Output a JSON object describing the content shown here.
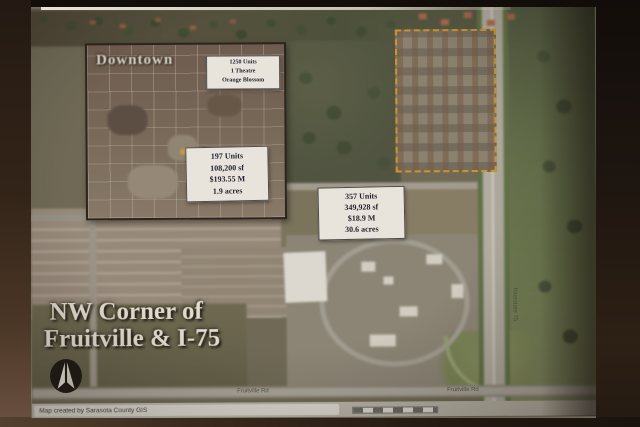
{
  "slide": {
    "inset": {
      "title": "Downtown",
      "program_box": {
        "lines": [
          "1250 Units",
          "1 Theatre",
          "Orange Blossom"
        ]
      },
      "stats_box": {
        "lines": [
          "197 Units",
          "108,200 sf",
          "$193.55 M",
          "1.9 acres"
        ]
      }
    },
    "site_box": {
      "lines": [
        "357 Units",
        "349,928 sf",
        "$18.9 M",
        "30.6 acres"
      ]
    },
    "title": {
      "line1": "NW Corner of",
      "line2": "Fruitville & I-75"
    },
    "roads": {
      "fruitville": "Fruitville Rd",
      "interstate": "Interstate 75"
    },
    "footer": {
      "attribution": "Map created by Sarasota County GIS"
    },
    "icons": {
      "north_arrow": "north-arrow"
    },
    "colors": {
      "parcel_outline": "#d89b2a",
      "wall_brown": "#3b2b1f",
      "field_olive": "#7c7660",
      "highway_gray": "#b8b5aa"
    }
  }
}
